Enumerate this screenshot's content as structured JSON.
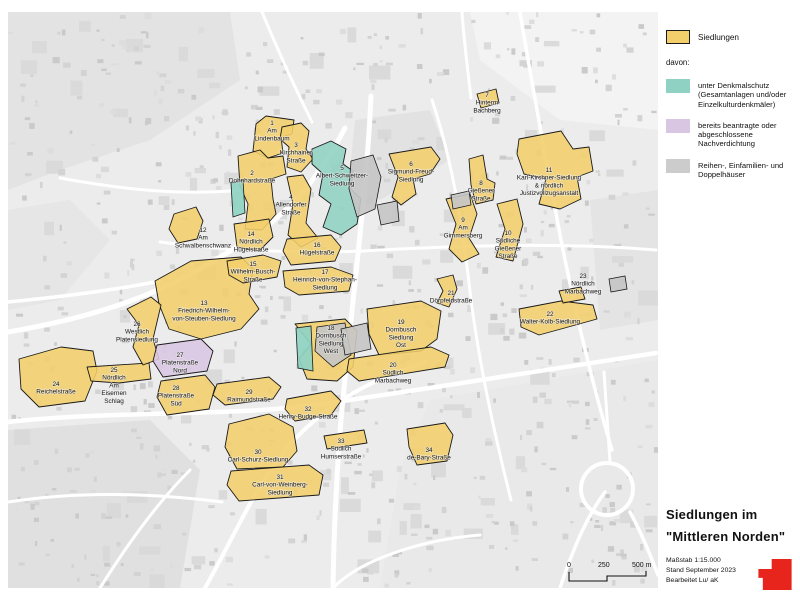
{
  "legend": {
    "siedlungen_label": "Siedlungen",
    "siedlungen_color": "#f2cf6b",
    "davon_label": "davon:",
    "items": [
      {
        "color": "#8fd2c3",
        "label": "unter Denkmalschutz (Gesamtanlagen und/oder Einzelkulturdenkmäler)"
      },
      {
        "color": "#d9c6e2",
        "label": "bereits beantragte oder abgeschlossene Nachverdichtung"
      },
      {
        "color": "#cccccc",
        "label": "Reihen-, Einfamilien- und Doppelhäuser"
      }
    ]
  },
  "title_block": {
    "line1": "Siedlungen im",
    "line2": "\"Mittleren Norden\"",
    "meta": [
      "Maßstab 1:15.000",
      "Stand September 2023",
      "Bearbeitet  Lu/ aK"
    ],
    "logo_color": "#e8251c"
  },
  "scale_bar": {
    "labels": [
      "0",
      "250",
      "500 m"
    ]
  },
  "map": {
    "settlements": [
      {
        "num": "1",
        "lines": [
          "Am",
          "Lindenbaum"
        ],
        "color": "y",
        "label": [
          272,
          125
        ],
        "points": "253,151 256,124 266,116 294,120 292,134 281,137 283,153 268,158"
      },
      {
        "num": "2",
        "lines": [
          "Dohnhardstraße"
        ],
        "color": "y",
        "label": [
          252,
          175
        ],
        "points": "238,156 260,150 268,158 283,156 286,174 271,179 273,199 276,214 262,230 245,229 248,204 240,186"
      },
      {
        "num": "3",
        "lines": [
          "Kirchhainer",
          "Straße"
        ],
        "color": "y",
        "label": [
          296,
          147
        ],
        "points": "282,127 301,123 309,131 306,149 313,159 301,172 287,167 289,147 280,139"
      },
      {
        "num": "4",
        "lines": [
          "Allendorfer",
          "Straße"
        ],
        "color": "y",
        "label": [
          291,
          199
        ],
        "points": "287,177 303,175 311,189 306,223 318,238 301,247 288,235 293,204"
      },
      {
        "num": "5",
        "lines": [
          "Albert-Schweitzer-",
          "Siedlung"
        ],
        "color": "t",
        "label": [
          342,
          170
        ],
        "points": "312,149 331,141 346,149 343,164 353,171 351,189 361,199 357,224 341,235 323,227 331,204 319,195 323,174 312,164"
      },
      {
        "num": "6",
        "lines": [
          "Sigmund-Freud-",
          "Siedlung"
        ],
        "color": "y",
        "label": [
          411,
          166
        ],
        "points": "389,154 431,147 440,159 430,174 413,179 416,194 401,205 392,197 398,177"
      },
      {
        "num": "7",
        "lines": [
          "Hinterm",
          "Bachberg"
        ],
        "color": "y",
        "label": [
          487,
          97
        ],
        "points": "477,94 496,89 499,103 481,108"
      },
      {
        "num": "8",
        "lines": [
          "Gießener",
          "Straße"
        ],
        "color": "y",
        "label": [
          481,
          185
        ],
        "points": "469,159 483,155 487,179 495,183 493,200 476,204 471,185"
      },
      {
        "num": "9",
        "lines": [
          "Am",
          "Gimmersberg"
        ],
        "color": "y",
        "label": [
          463,
          222
        ],
        "points": "446,199 470,194 477,214 469,238 479,254 462,262 449,249 456,224"
      },
      {
        "num": "10",
        "lines": [
          "Südliche",
          "Gießener",
          "Straße"
        ],
        "color": "y",
        "label": [
          508,
          235
        ],
        "points": "497,204 517,199 523,224 513,261 496,257 505,229"
      },
      {
        "num": "11",
        "lines": [
          "Karl-Kirchner-Siedlung",
          "& nördlich",
          "Justizvollzugsanstalt"
        ],
        "color": "y",
        "label": [
          549,
          172
        ],
        "points": "519,139 561,131 573,149 589,147 593,171 577,177 581,199 560,209 539,204 546,179 524,174 517,154"
      },
      {
        "num": "12",
        "lines": [
          "Am",
          "Schwalbenschwanz"
        ],
        "color": "y",
        "label": [
          203,
          232
        ],
        "points": "174,214 196,207 203,221 197,239 178,243 169,229"
      },
      {
        "num": "13",
        "lines": [
          "Friedrich-Wilhelm-",
          "von-Steuben-Siedlung"
        ],
        "color": "y",
        "label": [
          204,
          305
        ],
        "points": "155,281 191,261 241,257 253,269 249,294 259,309 241,329 201,339 169,329 159,304"
      },
      {
        "num": "14",
        "lines": [
          "Nördlich",
          "Hügelstraße"
        ],
        "color": "y",
        "label": [
          251,
          236
        ],
        "points": "234,224 269,219 273,237 259,251 237,247"
      },
      {
        "num": "15",
        "lines": [
          "Wilhelm-Busch-",
          "Straße"
        ],
        "color": "y",
        "label": [
          253,
          266
        ],
        "points": "227,261 263,255 281,261 277,277 243,283 229,275"
      },
      {
        "num": "16",
        "lines": [
          "Hügelstraße"
        ],
        "color": "y",
        "label": [
          317,
          247
        ],
        "points": "287,239 331,235 341,247 335,261 291,265 283,251"
      },
      {
        "num": "17",
        "lines": [
          "Heinrich-von-Stephan-",
          "Siedlung"
        ],
        "color": "y",
        "label": [
          325,
          274
        ],
        "points": "283,271 331,267 353,275 349,291 299,295 285,287"
      },
      {
        "num": "18",
        "lines": [
          "Dornbusch",
          "Siedlung",
          "West"
        ],
        "color": "y",
        "label": [
          331,
          330
        ],
        "points": "295,324 345,319 357,331 353,367 337,381 307,379 299,359 311,344"
      },
      {
        "num": "19",
        "lines": [
          "Dornbusch",
          "Siedlung",
          "Ost"
        ],
        "color": "y",
        "label": [
          401,
          324
        ],
        "points": "367,309 421,301 441,311 437,339 421,351 379,355 369,334"
      },
      {
        "num": "20",
        "lines": [
          "Südlich",
          "Marbachweg"
        ],
        "color": "y",
        "label": [
          393,
          367
        ],
        "points": "349,359 431,347 449,355 445,367 359,381 347,371"
      },
      {
        "num": "21",
        "lines": [
          "Dörpfeldstraße"
        ],
        "color": "y",
        "label": [
          451,
          295
        ],
        "points": "437,279 453,275 457,289 449,307 437,303 443,291"
      },
      {
        "num": "22",
        "lines": [
          "Walter-Kolb-Siedlung"
        ],
        "color": "y",
        "label": [
          550,
          316
        ],
        "points": "519,309 561,301 593,305 597,319 561,329 539,335 521,327"
      },
      {
        "num": "23",
        "lines": [
          "Nördlich",
          "Marbachweg"
        ],
        "color": "y",
        "label": [
          583,
          278
        ],
        "points": "559,291 581,287 585,299 563,303"
      },
      {
        "num": "24",
        "lines": [
          "Reichelstraße"
        ],
        "color": "y",
        "label": [
          56,
          386
        ],
        "points": "19,359 61,347 93,351 97,371 85,401 39,407 21,389"
      },
      {
        "num": "25",
        "lines": [
          "Nördlich",
          "Am",
          "Eisernen",
          "Schlag"
        ],
        "color": "y",
        "label": [
          114,
          372
        ],
        "points": "87,367 149,363 151,379 119,383 91,381"
      },
      {
        "num": "26",
        "lines": [
          "Westlich",
          "Platensiedlung"
        ],
        "color": "y",
        "label": [
          137,
          326
        ],
        "points": "127,309 151,297 161,305 153,339 159,359 143,365 133,347 139,325"
      },
      {
        "num": "27",
        "lines": [
          "Platenstraße",
          "Nord"
        ],
        "color": "p",
        "label": [
          180,
          357
        ],
        "points": "157,345 201,339 213,351 207,371 163,377 153,361"
      },
      {
        "num": "28",
        "lines": [
          "Platenstraße",
          "Süd"
        ],
        "color": "y",
        "label": [
          176,
          390
        ],
        "points": "161,381 205,375 215,387 209,409 167,415 157,397"
      },
      {
        "num": "29",
        "lines": [
          "Raimundstraße"
        ],
        "color": "y",
        "label": [
          249,
          394
        ],
        "points": "217,384 269,377 281,387 273,399 225,405 213,395"
      },
      {
        "num": "30",
        "lines": [
          "Carl-Schurz-Siedlung"
        ],
        "color": "y",
        "label": [
          258,
          454
        ],
        "points": "229,424 269,414 293,427 297,451 283,467 237,469 225,447"
      },
      {
        "num": "31",
        "lines": [
          "Carl-von-Weinberg-",
          "Siedlung"
        ],
        "color": "y",
        "label": [
          280,
          479
        ],
        "points": "231,471 309,465 323,475 319,495 239,501 227,485"
      },
      {
        "num": "32",
        "lines": [
          "Henry-Budge-Straße"
        ],
        "color": "y",
        "label": [
          308,
          411
        ],
        "points": "287,399 331,391 341,401 331,415 295,421 285,409"
      },
      {
        "num": "33",
        "lines": [
          "Südlich",
          "Humserstraße"
        ],
        "color": "y",
        "label": [
          341,
          443
        ],
        "points": "324,436 364,430 367,443 327,449"
      },
      {
        "num": "34",
        "lines": [
          "de-Bary-Straße"
        ],
        "color": "y",
        "label": [
          429,
          452
        ],
        "points": "407,429 445,423 453,435 447,461 417,465 409,447"
      }
    ],
    "patches": [
      {
        "color": "teal",
        "points": "231,183 243,180 245,213 233,217"
      },
      {
        "color": "teal",
        "points": "296,328 311,326 313,371 298,368"
      },
      {
        "color": "gray",
        "points": "351,161 373,155 381,177 375,209 357,217 349,189"
      },
      {
        "color": "gray",
        "points": "317,327 345,323 351,355 333,367 315,351"
      },
      {
        "color": "gray",
        "points": "341,329 367,323 371,349 345,355"
      },
      {
        "color": "gray",
        "points": "377,205 397,201 399,221 381,225"
      },
      {
        "color": "gray",
        "points": "451,195 469,191 471,205 453,209"
      },
      {
        "color": "gray",
        "points": "609,279 625,276 627,289 611,292"
      }
    ]
  }
}
